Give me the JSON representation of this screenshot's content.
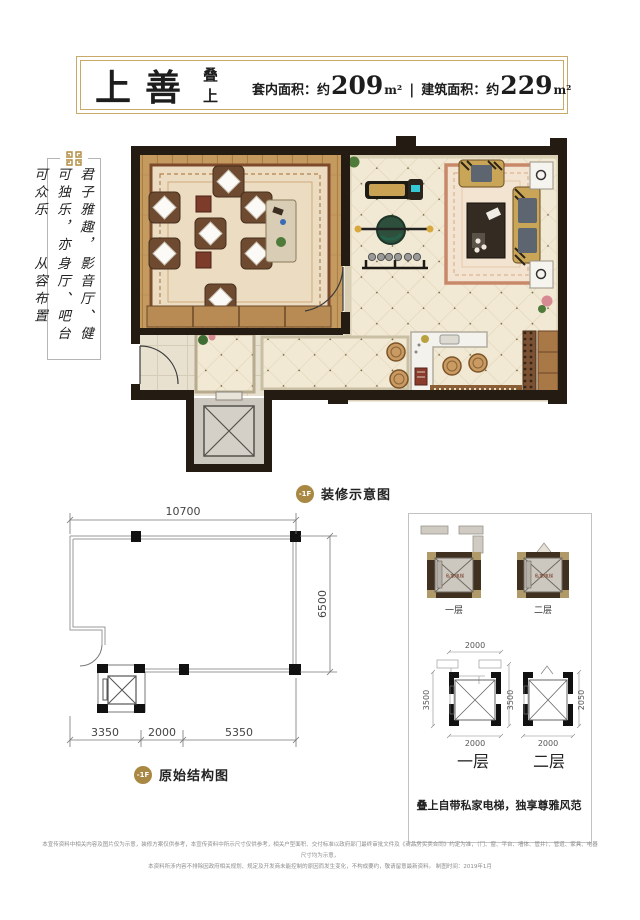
{
  "header": {
    "title": "上善",
    "subtitle": "叠上",
    "area1_label": "套内面积：约",
    "area1_value": "209",
    "area1_unit": "m²",
    "area_sep": "|",
    "area2_label": "建筑面积：约",
    "area2_value": "229",
    "area2_unit": "m²"
  },
  "side_note": {
    "col1": "君子雅趣，可独乐，亦可众乐",
    "col2": "影音厅、健身厅、吧台从容布置"
  },
  "plan_decorated": {
    "badge": "-1F",
    "label": "装修示意图"
  },
  "plan_structure": {
    "badge": "-1F",
    "label": "原始结构图",
    "dim_top": "10700",
    "dim_right": "6500",
    "dim_b1": "3350",
    "dim_b2": "2000",
    "dim_b3": "5350"
  },
  "elevator_panel": {
    "cab_text": "私家电梯",
    "floor1_small": "一层",
    "floor2_small": "二层",
    "s1_top": "2000",
    "s1_left": "3500",
    "s1_right": "3500",
    "s1_bottom": "2000",
    "s2_right": "2050",
    "s2_bottom": "2000",
    "floor1_large": "一层",
    "floor2_large": "二层",
    "caption": "叠上自带私家电梯，独享尊雅风范"
  },
  "footer": {
    "line1": "本宣传资料中相关内容及图片仅为示意，装修方案仅供参考，本宣传资料中所示尺寸仅供参考，相关户型面积、交付标准以政府部门最终审批文件及《商品房买卖合同》约定为准，（门、窗、平台、墙体、管井）、管道、家具、电器尺寸均为示意，",
    "line2": "本资料所涉内容不排除因政府相关规划、规定及开发商未能控制的原因而发生变化，不构成要约，敬请留意最新资料。  制图时间：2019年1月"
  },
  "colors": {
    "gold_border": "#c7a96a",
    "badge_gold": "#a98843",
    "wall_dark": "#241c12",
    "wood": "#c49a5f",
    "tile_cream": "#f2e9d4",
    "dim_text": "#555555"
  }
}
